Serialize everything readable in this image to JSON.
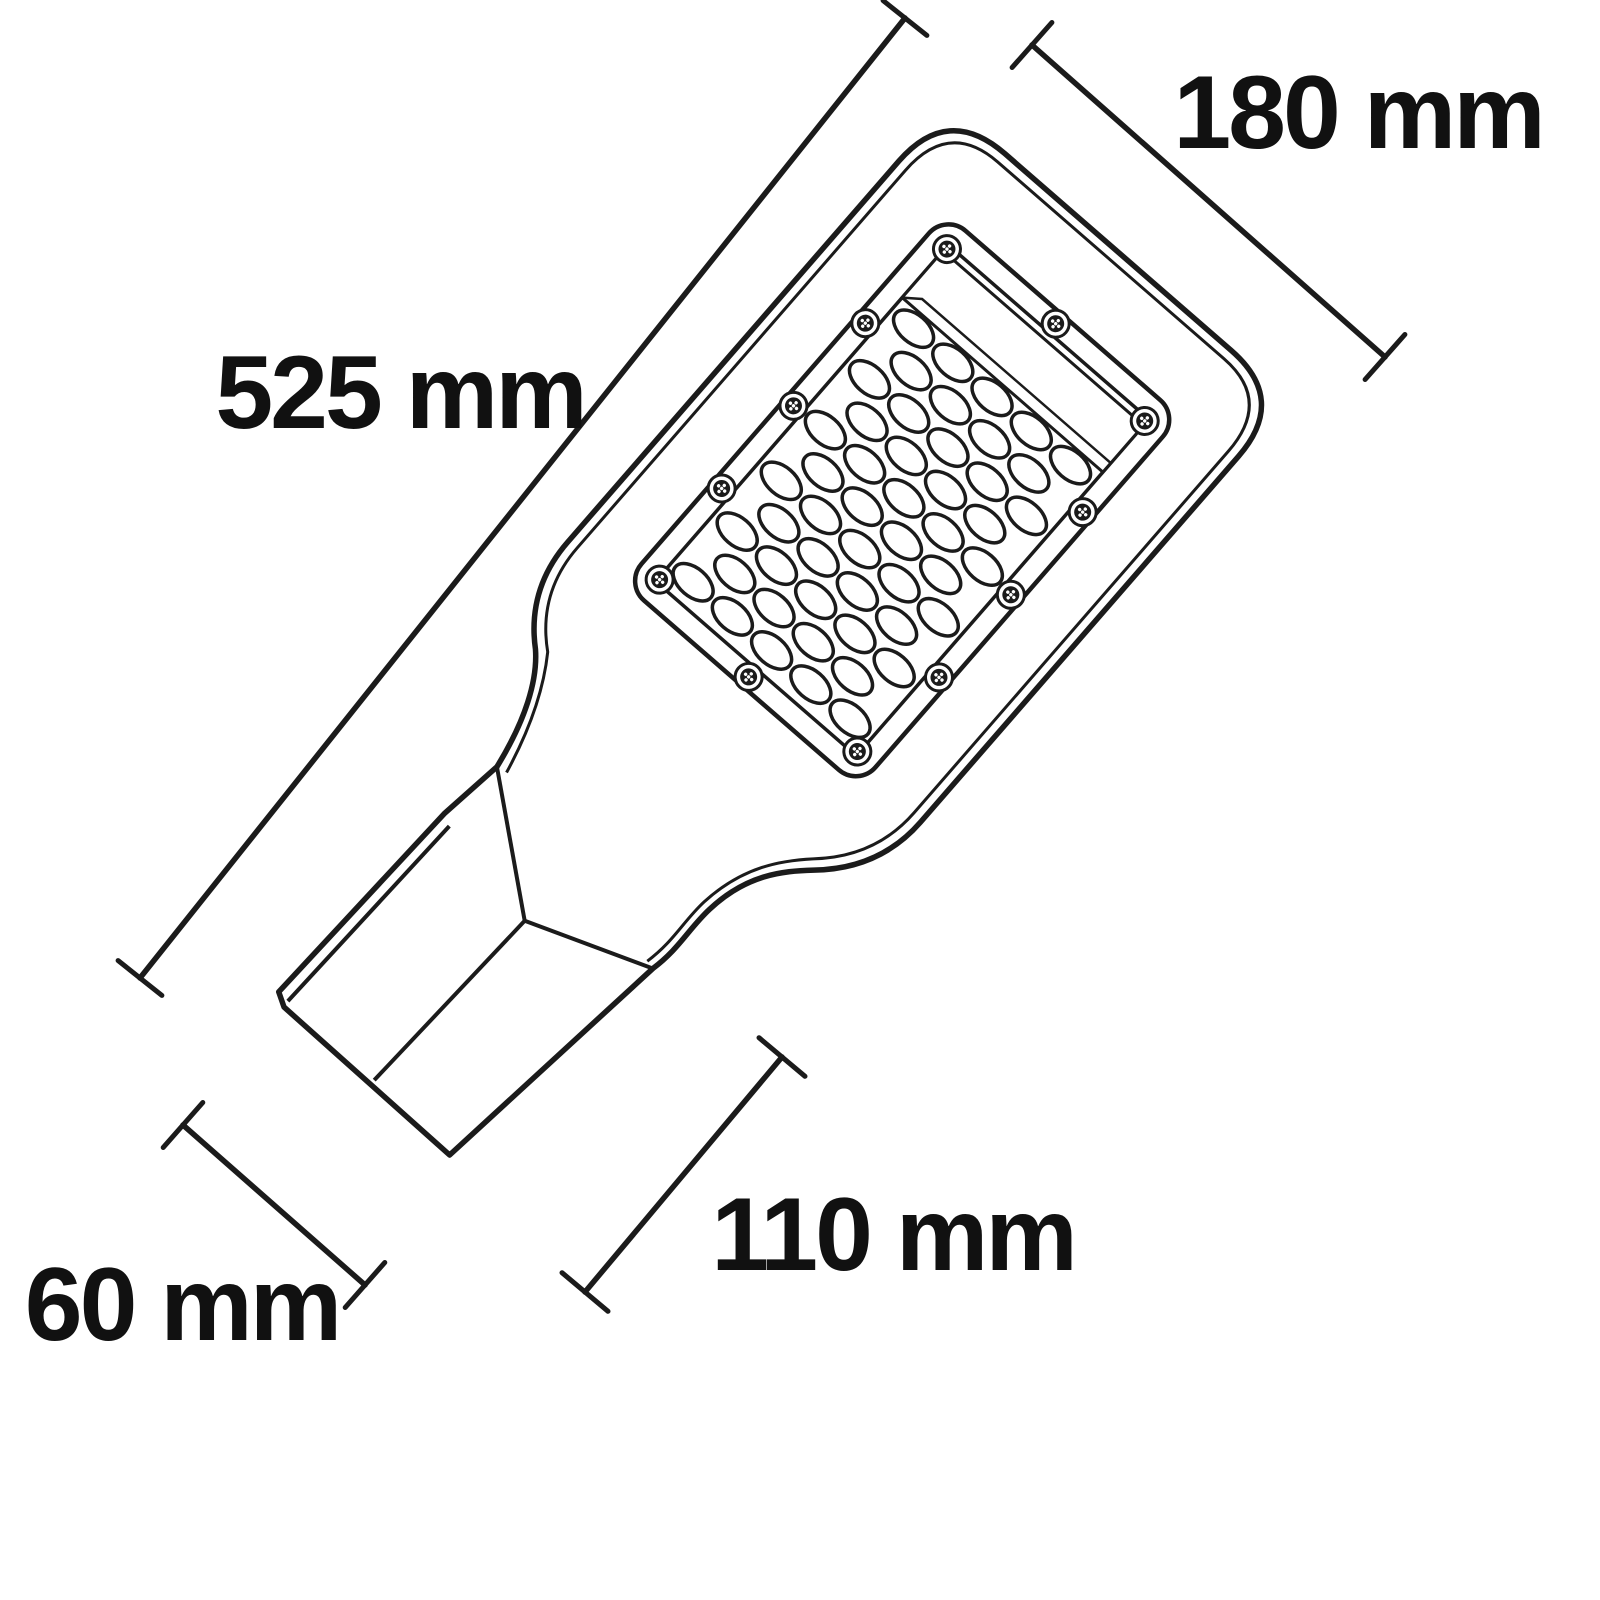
{
  "diagram": {
    "type": "technical-dimension-drawing",
    "subject": "LED street light head with pole-mount bracket, viewed from the LED side, rotated diagonally",
    "background_color": "#ffffff",
    "line_color": "#1b1b1b",
    "text_color": "#111111",
    "dimensions": {
      "overall_length": {
        "label": "525 mm",
        "value": 525,
        "unit": "mm"
      },
      "head_width": {
        "label": "180 mm",
        "value": 180,
        "unit": "mm"
      },
      "bracket_length": {
        "label": "110 mm",
        "value": 110,
        "unit": "mm"
      },
      "bracket_width": {
        "label": "60 mm",
        "value": 60,
        "unit": "mm"
      }
    },
    "led_grid": {
      "full_rows": 6,
      "lenses_per_full_row": 5,
      "offset_rows": 5,
      "lenses_per_offset_row": 4,
      "total_lenses": 50
    },
    "screws": {
      "count": 12,
      "style": "torx"
    }
  }
}
